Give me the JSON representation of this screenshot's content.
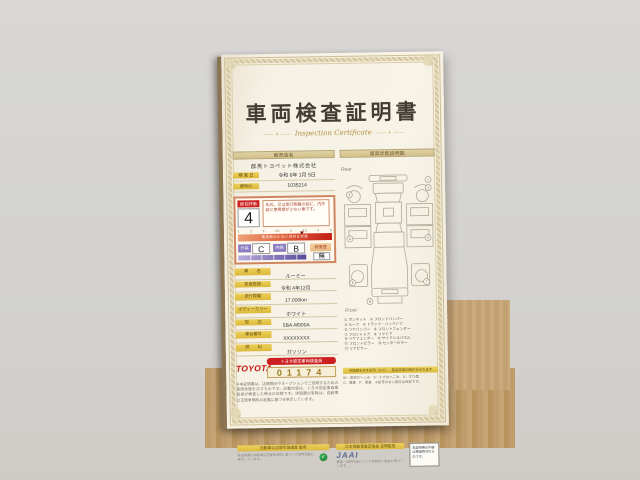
{
  "title": {
    "main": "車両検査証明書",
    "sub": "Inspection Certificate"
  },
  "dealer": {
    "section_header": "販売店名",
    "name": "群馬トヨペット株式会社",
    "rows": [
      {
        "label": "検 査 日",
        "value": "令和 6年 1月 5日"
      },
      {
        "label": "車両ID",
        "value": "1035214"
      }
    ]
  },
  "evaluation": {
    "label": "総合評価",
    "score": "4",
    "description": "年式、又は走行距離の割に、内外装に使用感が少ない車です。",
    "scale_ticks": [
      "1",
      "2",
      "3",
      "3.5",
      "4",
      "4.5",
      "5",
      "S"
    ],
    "bar_text": "使用感の少ない良好な状態",
    "exterior_label": "外装",
    "exterior_grade": "C",
    "interior_label": "内装",
    "interior_grade": "B",
    "repair_label": "修復歴",
    "repair_value": "無"
  },
  "specs": [
    {
      "label": "車　　名",
      "value": "ルーミー"
    },
    {
      "label": "初度登録",
      "value": "令和 4年12月"
    },
    {
      "label": "走行距離",
      "value": "17,000km"
    },
    {
      "label": "ボディーカラー",
      "value": "ホワイト"
    },
    {
      "label": "型　　式",
      "value": "5BA-M900A"
    },
    {
      "label": "車台番号",
      "value": "XXXXXXXX"
    },
    {
      "label": "燃　　料",
      "value": "ガソリン"
    }
  ],
  "inspector": {
    "brand": "TOYOTA",
    "band": "トヨタ認定車両検査員",
    "number": "01174"
  },
  "fine_print": "※本証明書は、店頭掲示やオークションでご説明するための車両状態を示すものです。記載内容は、トヨタ認定車両検査員が検査した時点の状態です。修復歴の有無は、自動車公正競争規約の定義に基づき表示しています。",
  "diagram": {
    "section_header": "車両状態説明図",
    "rear_label": "Rear",
    "front_label": "Front",
    "legend": [
      "① ボンネット　② フロントバンパー",
      "③ ルーフ　④ トランク・バックドア",
      "⑤ リヤバンパー　⑥ フロントフェンダー",
      "⑦ フロントドア　⑧ リヤドア",
      "⑨ リヤフェンダー　⑩ サイドシルパネル",
      "⑪ フロントピラー　⑫ センターピラー",
      "⑬ リヤピラー"
    ],
    "note_header": "交換歴を示す記号（X X）…部品交換の跡がみられます",
    "note_lines": [
      "W：波状のへこみ　A：小さなへこみ　S：すり傷",
      "C：腐食　P：塗装　※記号のない部分は良好です。"
    ],
    "markers": [
      {
        "n": "1",
        "x": 86,
        "y": 8
      },
      {
        "n": "2",
        "x": 86,
        "y": 16
      },
      {
        "n": "3",
        "x": 7,
        "y": 22
      },
      {
        "n": "4",
        "x": 7,
        "y": 66
      },
      {
        "n": "5",
        "x": 85,
        "y": 66
      },
      {
        "n": "6",
        "x": 9,
        "y": 110
      },
      {
        "n": "7",
        "x": 83,
        "y": 110
      },
      {
        "n": "8",
        "x": 26,
        "y": 129
      }
    ]
  },
  "footer": {
    "left_header": "自動車公正取引協議会 監修",
    "left_note": "本証明書は自動車公正競争規約に基づいて車両状態を表示しています。",
    "green_mark": "✓",
    "right_header": "日本自動車査定協会 定期監査",
    "right_logo": "JAAI",
    "right_note": "検査・証明内容について定期的に監査を受けています。",
    "box_note": "本証明書の内容は検査時点のものです。"
  }
}
